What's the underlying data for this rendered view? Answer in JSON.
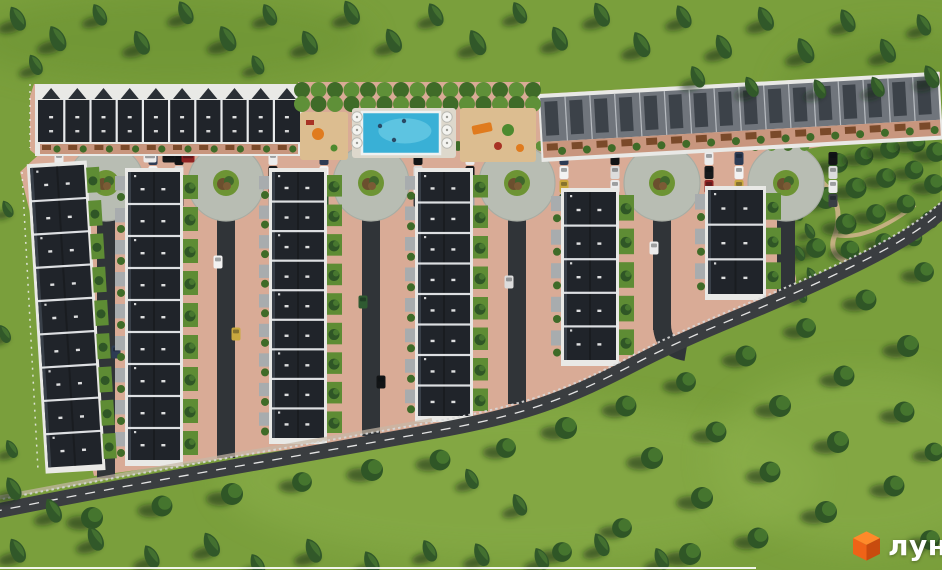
{
  "watermark": {
    "text": "лун",
    "text_color": "#ffffff",
    "cube_top": "#ff8a2a",
    "cube_left": "#ef6317",
    "cube_right": "#c84b0e"
  },
  "scene": {
    "width": 942,
    "height": 570,
    "palette": {
      "grass": "#7a9f3c",
      "grass_light": "#8cb04b",
      "grass_dark": "#6a9132",
      "conifer_dark": "#22401f",
      "conifer_mid": "#315829",
      "conifer_light": "#4b7a33",
      "tree_shadow": "rgba(22,40,16,0.55)",
      "round_tree": "#2f5626",
      "round_tree_light": "#4d8032",
      "pavement": "#d9ab96",
      "pavement_dark": "#c8967e",
      "deck": "#ddd8cc",
      "pool_water": "#39b0d6",
      "pool_water_light": "#82d8ec",
      "pool_edge": "#eef2f2",
      "sand": "#dcbd90",
      "equip_orange": "#e07b1e",
      "equip_red": "#a83224",
      "equip_green": "#4d8a2f",
      "roundabout": "#b8bdb3",
      "roundabout_ring": "#a7aca3",
      "island": "#6d9434",
      "island_bush1": "#6b4f2e",
      "island_bush2": "#3f662c",
      "island_bush3": "#7a5b35",
      "road": "#3a3d40",
      "road_line": "#e4e4e4",
      "guardrail": "#d8d8d8",
      "sidewalk": "#c6b8a6",
      "lane": "#303438",
      "roof_dark": "#20242a",
      "roof_dark_edge": "#394049",
      "ridge": "#e8eaec",
      "wall_white": "#e9e9e6",
      "roof_gray": "#70757c",
      "roof_panel": "#3c4249",
      "roof_gray_div": "#b8bcc1",
      "yard_green": "#5e8c34",
      "terrace": "#a8acae",
      "fence_brown": "#7a4a2a",
      "hedge_dark": "#3f6b28",
      "hedge_light": "#5f9038",
      "park_green": "#6e9637",
      "path_tan": "#cdb389",
      "people": "#2a4a66",
      "bottom_line": "#ffffff"
    },
    "grass_patches": [
      [
        170,
        40,
        200,
        45,
        "dark"
      ],
      [
        520,
        480,
        300,
        80,
        "light"
      ],
      [
        860,
        460,
        150,
        90,
        "light"
      ],
      [
        470,
        300,
        160,
        60,
        "light"
      ],
      [
        900,
        90,
        120,
        60,
        "dark"
      ]
    ],
    "field_outline": "48,146 814,146 808,248 790,296 702,338 640,354 560,394 470,420 300,448 180,464 94,476 20,172",
    "blocks": {
      "top_left": "34,84 302,84 302,168 52,168 30,150 30,96",
      "amenity": "298,82 540,82 540,168 298,168",
      "top_right": "538,94 940,72 940,132 814,150 538,164"
    },
    "park": {
      "outline": "790,152 940,126 940,208 872,258 800,298 786,230",
      "path1": "M 800 170 C 830 180 845 205 835 235 C 825 258 850 270 880 258",
      "path2": "M 835 235 C 860 240 890 225 915 205",
      "trees": [
        [
          812,
          172,
          0.85
        ],
        [
          838,
          163,
          0.9
        ],
        [
          864,
          156,
          0.85
        ],
        [
          890,
          149,
          0.9
        ],
        [
          916,
          143,
          0.85
        ],
        [
          936,
          152,
          0.9
        ],
        [
          826,
          198,
          1
        ],
        [
          856,
          188,
          0.95
        ],
        [
          886,
          178,
          0.9
        ],
        [
          914,
          170,
          0.85
        ],
        [
          934,
          184,
          0.9
        ],
        [
          846,
          224,
          0.95
        ],
        [
          876,
          214,
          0.9
        ],
        [
          906,
          204,
          0.85
        ],
        [
          930,
          220,
          0.8
        ],
        [
          816,
          248,
          0.9
        ],
        [
          850,
          250,
          0.85
        ],
        [
          884,
          242,
          0.8
        ],
        [
          914,
          238,
          0.75
        ]
      ],
      "cypresses": [
        [
          798,
          214
        ],
        [
          810,
          232
        ],
        [
          800,
          254
        ],
        [
          812,
          276
        ],
        [
          802,
          296
        ]
      ]
    },
    "road": {
      "d": "M -8 512 C 140 482 300 456 430 432 C 525 415 565 400 642 360 C 705 328 765 308 832 276 C 892 248 922 230 950 204",
      "rail_d": "M -8 501 C 140 472 300 446 432 422 C 526 405 566 391 643 350 C 706 318 766 298 834 266 C 893 239 923 220 950 194",
      "sidewalk_d": "M -8 499 C 140 470 300 444 432 420",
      "width": 15
    },
    "street": {
      "x1": 52,
      "x2": 812,
      "y1": 146,
      "y2": 172,
      "tree_y": 146,
      "tree_x1": 62,
      "tree_x2": 808,
      "tree_step": 16.5,
      "tree_r": 5
    },
    "roundabouts": {
      "xs": [
        106,
        226,
        371,
        517,
        662,
        786
      ],
      "y": 183,
      "r_pad": 38,
      "r_island": 13
    },
    "lane_w": 18,
    "lane_y1": 180,
    "lanes": [
      {
        "x": 106,
        "y2": 478
      },
      {
        "x": 226,
        "y2": 458
      },
      {
        "x": 371,
        "y2": 436
      },
      {
        "x": 517,
        "y2": 404
      },
      {
        "x": 662,
        "y2": 330,
        "curve": true
      },
      {
        "x": 786,
        "y2": 294
      }
    ],
    "cars": {
      "colors": [
        "#ececec",
        "#17191b",
        "#8e2222",
        "#9da3a7",
        "#2d3b54",
        "#f2f2f2",
        "#c9a83e",
        "#2f5a31",
        "#121416",
        "#dcdcdc",
        "#ececec",
        "#3a3f44"
      ],
      "w": 9,
      "h": 13,
      "col_dx": [
        -47,
        47
      ],
      "start_y": 152,
      "step": 14,
      "per_col": 4,
      "extra_h": [
        [
          150,
          158
        ],
        [
          169,
          158
        ],
        [
          188,
          158
        ]
      ],
      "yard": [
        [
          98,
          280
        ],
        [
          116,
          352
        ],
        [
          218,
          262
        ],
        [
          236,
          334
        ],
        [
          363,
          302
        ],
        [
          381,
          382
        ],
        [
          509,
          282
        ],
        [
          654,
          248
        ]
      ]
    },
    "row_w": 52,
    "rows_vertical": [
      {
        "x": 128,
        "y": 172,
        "h": 288,
        "units": 9
      },
      {
        "x": 272,
        "y": 172,
        "h": 266,
        "units": 9
      },
      {
        "x": 418,
        "y": 172,
        "h": 244,
        "units": 8
      },
      {
        "x": 564,
        "y": 192,
        "h": 168,
        "units": 5
      },
      {
        "x": 708,
        "y": 190,
        "w": 55,
        "h": 104,
        "units": 3
      }
    ],
    "row_diagonal": {
      "x": 30,
      "y": 168,
      "w": 54,
      "h": 300,
      "units": 9,
      "angle": -3.5
    },
    "row_top_left": {
      "x": 38,
      "y": 86,
      "w": 262,
      "h": 68,
      "units": 10
    },
    "row_top_right": {
      "x": 540,
      "y": 96,
      "w": 398,
      "h": 64,
      "units": 16,
      "angle": -3.2
    },
    "amenity": {
      "hedge": {
        "x1": 302,
        "x2": 536,
        "rows": [
          90,
          104
        ],
        "step": 16.5,
        "r": 8
      },
      "deck": [
        352,
        108,
        104,
        50
      ],
      "pool": [
        362,
        112,
        78,
        42
      ],
      "people": [
        [
          380,
          126
        ],
        [
          404,
          121
        ],
        [
          394,
          140
        ]
      ],
      "umbrellas": {
        "xs": [
          357,
          447
        ],
        "ys": [
          117,
          130,
          143
        ],
        "r": 5.2
      },
      "pg_left": [
        300,
        112,
        48,
        48
      ],
      "pg_right": [
        460,
        108,
        76,
        54
      ]
    },
    "fences": {
      "left_diag": "M 22 172 L 38 470",
      "top_left": "M 30 84 L 30 148"
    },
    "conifers": [
      [
        18,
        20,
        1
      ],
      [
        58,
        40,
        1.05
      ],
      [
        100,
        16,
        0.9
      ],
      [
        142,
        44,
        1
      ],
      [
        186,
        14,
        0.95
      ],
      [
        228,
        40,
        1.05
      ],
      [
        270,
        16,
        0.9
      ],
      [
        310,
        44,
        1
      ],
      [
        352,
        14,
        1
      ],
      [
        394,
        42,
        1
      ],
      [
        436,
        16,
        0.95
      ],
      [
        478,
        44,
        1.05
      ],
      [
        520,
        14,
        0.9
      ],
      [
        560,
        40,
        1
      ],
      [
        602,
        16,
        1
      ],
      [
        642,
        46,
        1.05
      ],
      [
        684,
        18,
        0.95
      ],
      [
        724,
        48,
        1
      ],
      [
        766,
        20,
        1
      ],
      [
        806,
        52,
        1.05
      ],
      [
        848,
        22,
        0.95
      ],
      [
        888,
        52,
        1
      ],
      [
        924,
        26,
        0.9
      ],
      [
        932,
        78,
        0.95
      ],
      [
        878,
        88,
        0.85
      ],
      [
        36,
        66,
        0.85
      ],
      [
        258,
        66,
        0.8
      ],
      [
        698,
        78,
        0.9
      ],
      [
        752,
        88,
        0.85
      ],
      [
        820,
        90,
        0.8
      ],
      [
        8,
        210,
        0.7
      ],
      [
        5,
        335,
        0.75
      ],
      [
        12,
        450,
        0.75
      ],
      [
        14,
        490,
        0.95
      ],
      [
        54,
        512,
        1
      ],
      [
        18,
        552,
        1
      ],
      [
        96,
        540,
        1
      ],
      [
        152,
        558,
        0.95
      ],
      [
        212,
        546,
        1
      ],
      [
        258,
        566,
        0.9
      ],
      [
        314,
        552,
        1
      ],
      [
        372,
        564,
        0.95
      ],
      [
        430,
        552,
        0.9
      ],
      [
        472,
        480,
        0.85
      ],
      [
        520,
        506,
        0.9
      ],
      [
        482,
        556,
        0.95
      ],
      [
        542,
        560,
        0.9
      ],
      [
        602,
        546,
        0.95
      ],
      [
        662,
        560,
        0.9
      ]
    ],
    "round_trees": [
      [
        92,
        518,
        1
      ],
      [
        162,
        506,
        0.95
      ],
      [
        232,
        494,
        1
      ],
      [
        302,
        482,
        0.9
      ],
      [
        372,
        470,
        1
      ],
      [
        440,
        460,
        0.95
      ],
      [
        506,
        448,
        0.9
      ],
      [
        566,
        428,
        1
      ],
      [
        626,
        406,
        0.95
      ],
      [
        686,
        382,
        0.9
      ],
      [
        746,
        356,
        0.95
      ],
      [
        806,
        328,
        0.9
      ],
      [
        866,
        300,
        0.95
      ],
      [
        924,
        272,
        0.9
      ],
      [
        652,
        458,
        1
      ],
      [
        716,
        432,
        0.95
      ],
      [
        780,
        406,
        1
      ],
      [
        844,
        376,
        0.95
      ],
      [
        908,
        346,
        1
      ],
      [
        702,
        498,
        1
      ],
      [
        770,
        472,
        0.95
      ],
      [
        838,
        442,
        1
      ],
      [
        904,
        412,
        0.95
      ],
      [
        622,
        528,
        0.9
      ],
      [
        690,
        554,
        1
      ],
      [
        758,
        538,
        0.95
      ],
      [
        826,
        512,
        1
      ],
      [
        894,
        486,
        0.95
      ],
      [
        930,
        540,
        0.9
      ],
      [
        934,
        452,
        0.85
      ],
      [
        562,
        552,
        0.9
      ]
    ],
    "bottom_line": [
      0,
      567,
      756,
      2
    ]
  }
}
